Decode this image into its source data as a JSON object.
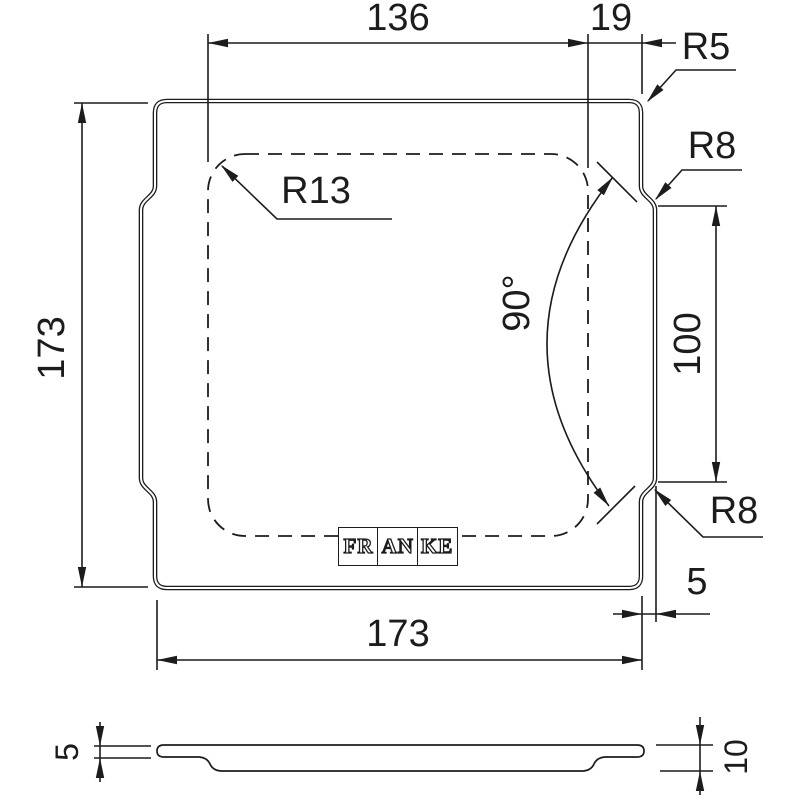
{
  "page": {
    "background": "#ffffff",
    "line_color": "#1c1c1c"
  },
  "top_view": {
    "dimensions": {
      "inner_width": "136",
      "corner_offset": "19",
      "outer_height": "173",
      "outer_width": "173",
      "notch_height": "100",
      "edge_offset": "5",
      "angle": "90°"
    },
    "radii": {
      "outer_corner": "R5",
      "notch_top": "R8",
      "notch_bottom": "R8",
      "inner_corner": "R13"
    },
    "logo_segments": [
      "FR",
      "AN",
      "KE"
    ]
  },
  "side_view": {
    "dimensions": {
      "edge_thickness": "5",
      "total_thickness": "10"
    }
  }
}
